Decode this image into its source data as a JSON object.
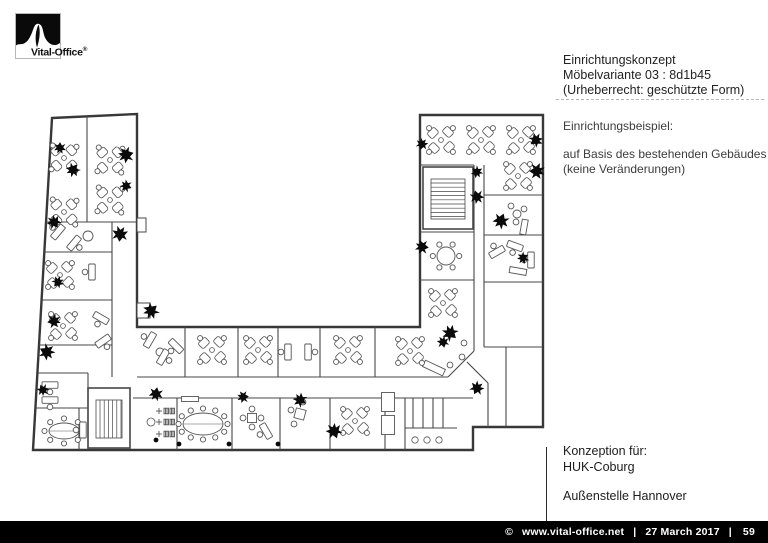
{
  "logo": {
    "brand": "Vital-Office",
    "reg": "®"
  },
  "title_block": {
    "line1": "Einrichtungskonzept",
    "line2": "Möbelvariante 03 : 8d1b45",
    "line3": "(Urheberrecht: geschützte Form)"
  },
  "example_block": {
    "heading": "Einrichtungsbeispiel:",
    "line1": "auf Basis des bestehenden Gebäudes",
    "line2": "(keine Veränderungen)"
  },
  "concept_block": {
    "line1": "Konzeption für:",
    "line2": "HUK-Coburg",
    "line3": "Außenstelle Hannover"
  },
  "footer": {
    "copyright": "©",
    "url": "www.vital-office.net",
    "separator": "|",
    "date": "27 March 2017",
    "page": "59"
  },
  "colors": {
    "bar_bg": "#000000",
    "bar_text": "#ffffff",
    "outline": "#383838",
    "wall": "#474747",
    "furniture": "#555555",
    "plant": "#0b0b0b"
  },
  "floorplan": {
    "outline": [
      [
        52,
        118
      ],
      [
        137,
        114
      ],
      [
        137,
        327
      ],
      [
        420,
        327
      ],
      [
        420,
        115
      ],
      [
        543,
        115
      ],
      [
        543,
        427
      ],
      [
        473,
        427
      ],
      [
        473,
        450
      ],
      [
        33,
        450
      ]
    ],
    "stubs": [
      [
        137,
        218,
        9,
        14
      ],
      [
        137,
        303,
        13,
        15
      ]
    ],
    "walls": [
      [
        87,
        116,
        87,
        222
      ],
      [
        46,
        222,
        137,
        222
      ],
      [
        44,
        252,
        112,
        252
      ],
      [
        42,
        300,
        112,
        300
      ],
      [
        39,
        345,
        112,
        345
      ],
      [
        38,
        373,
        88,
        373
      ],
      [
        36,
        408,
        88,
        408
      ],
      [
        112,
        222,
        112,
        377
      ],
      [
        88,
        373,
        88,
        450
      ],
      [
        79,
        408,
        79,
        450
      ],
      [
        137,
        377,
        448,
        377
      ],
      [
        448,
        377,
        474,
        351
      ],
      [
        133,
        398,
        473,
        398
      ],
      [
        185,
        327,
        185,
        377
      ],
      [
        238,
        327,
        238,
        377
      ],
      [
        278,
        327,
        278,
        377
      ],
      [
        320,
        327,
        320,
        377
      ],
      [
        375,
        327,
        375,
        377
      ],
      [
        177,
        398,
        177,
        450
      ],
      [
        232,
        398,
        232,
        450
      ],
      [
        280,
        398,
        280,
        450
      ],
      [
        330,
        398,
        330,
        450
      ],
      [
        385,
        398,
        385,
        450
      ],
      [
        405,
        398,
        405,
        450
      ],
      [
        413,
        398,
        413,
        428
      ],
      [
        423,
        398,
        423,
        428
      ],
      [
        433,
        398,
        433,
        428
      ],
      [
        443,
        398,
        443,
        428
      ],
      [
        405,
        428,
        457,
        428
      ],
      [
        420,
        165,
        474,
        165
      ],
      [
        484,
        195,
        543,
        195
      ],
      [
        474,
        165,
        474,
        351
      ],
      [
        484,
        165,
        484,
        347
      ],
      [
        420,
        232,
        474,
        232
      ],
      [
        420,
        280,
        474,
        280
      ],
      [
        484,
        235,
        543,
        235
      ],
      [
        484,
        282,
        543,
        282
      ],
      [
        484,
        347,
        543,
        347
      ],
      [
        488,
        383,
        488,
        427
      ],
      [
        506,
        347,
        506,
        427
      ],
      [
        467,
        362,
        488,
        383
      ]
    ],
    "stairs": [
      {
        "x": 88,
        "y": 388,
        "w": 42,
        "h": 60,
        "dir": "h"
      },
      {
        "x": 423,
        "y": 167,
        "w": 50,
        "h": 62,
        "dir": "v"
      }
    ],
    "clusters": [
      [
        64,
        158,
        3
      ],
      [
        64,
        212,
        3
      ],
      [
        110,
        160,
        3
      ],
      [
        110,
        200,
        3
      ],
      [
        60,
        275,
        0
      ],
      [
        63,
        326,
        0
      ],
      [
        212,
        350,
        0
      ],
      [
        258,
        350,
        0
      ],
      [
        348,
        350,
        0
      ],
      [
        410,
        351,
        0
      ],
      [
        355,
        421,
        0
      ],
      [
        443,
        303,
        0
      ],
      [
        441,
        140,
        0
      ],
      [
        481,
        140,
        0
      ],
      [
        521,
        140,
        0
      ],
      [
        518,
        176,
        0
      ]
    ],
    "desks": [
      [
        92,
        272,
        90
      ],
      [
        101,
        318,
        30
      ],
      [
        103,
        341,
        325
      ],
      [
        58,
        232,
        130
      ],
      [
        74,
        243,
        310
      ],
      [
        50,
        385,
        0
      ],
      [
        50,
        400,
        0
      ],
      [
        83,
        430,
        90
      ],
      [
        150,
        340,
        120
      ],
      [
        163,
        357,
        300
      ],
      [
        176,
        346,
        45
      ],
      [
        288,
        352,
        90
      ],
      [
        308,
        352,
        270
      ],
      [
        266,
        431,
        60
      ],
      [
        497,
        252,
        150
      ],
      [
        515,
        246,
        20
      ],
      [
        531,
        260,
        90
      ]
    ],
    "ovals": [
      {
        "cx": 203,
        "cy": 424,
        "rx": 20,
        "ry": 11,
        "chairs": 12
      },
      {
        "cx": 64,
        "cy": 431,
        "rx": 15,
        "ry": 8,
        "chairs": 8
      }
    ],
    "round_tables": [
      {
        "cx": 446,
        "cy": 256,
        "r": 9,
        "chairs": 6
      },
      {
        "cx": 88,
        "cy": 236,
        "r": 5,
        "chairs": 0
      },
      {
        "cx": 160,
        "cy": 352,
        "r": 4,
        "chairs": 0
      },
      {
        "cx": 517,
        "cy": 214,
        "r": 4,
        "chairs": 0
      }
    ],
    "squares": [
      [
        252,
        418,
        9,
        9,
        0
      ],
      [
        300,
        414,
        10,
        10,
        15
      ],
      [
        388,
        402,
        13,
        19,
        0
      ],
      [
        388,
        425,
        13,
        19,
        0
      ],
      [
        190,
        399,
        17,
        5,
        0
      ]
    ],
    "benches": [
      [
        434,
        368,
        22,
        7,
        25
      ],
      [
        518,
        271,
        17,
        6,
        10
      ],
      [
        524,
        227,
        15,
        6,
        100
      ]
    ],
    "stools": [
      [
        291,
        410
      ],
      [
        303,
        402
      ],
      [
        294,
        424
      ],
      [
        511,
        206
      ],
      [
        524,
        209
      ],
      [
        516,
        222
      ],
      [
        464,
        343
      ],
      [
        462,
        357
      ],
      [
        450,
        365
      ],
      [
        252,
        409
      ],
      [
        252,
        427
      ],
      [
        243,
        418
      ],
      [
        261,
        418
      ]
    ],
    "coats": [
      [
        165,
        411
      ],
      [
        165,
        422
      ],
      [
        165,
        434
      ]
    ],
    "sinks": [
      [
        415,
        440
      ],
      [
        427,
        440
      ],
      [
        439,
        440
      ]
    ],
    "bins": [
      [
        151,
        422,
        4
      ]
    ],
    "small_dots": [
      [
        179,
        444
      ],
      [
        229,
        444
      ],
      [
        278,
        444
      ],
      [
        156,
        440
      ]
    ],
    "plants": [
      [
        60,
        148
      ],
      [
        73,
        170
      ],
      [
        126,
        155
      ],
      [
        126,
        186
      ],
      [
        54,
        222
      ],
      [
        120,
        234
      ],
      [
        58,
        282
      ],
      [
        54,
        321
      ],
      [
        47,
        352
      ],
      [
        43,
        390
      ],
      [
        156,
        394
      ],
      [
        151,
        311
      ],
      [
        243,
        397
      ],
      [
        300,
        400
      ],
      [
        334,
        431
      ],
      [
        422,
        144
      ],
      [
        536,
        140
      ],
      [
        537,
        171
      ],
      [
        477,
        172
      ],
      [
        477,
        197
      ],
      [
        501,
        221
      ],
      [
        523,
        258
      ],
      [
        422,
        247
      ],
      [
        450,
        333
      ],
      [
        443,
        342
      ],
      [
        477,
        388
      ]
    ]
  }
}
